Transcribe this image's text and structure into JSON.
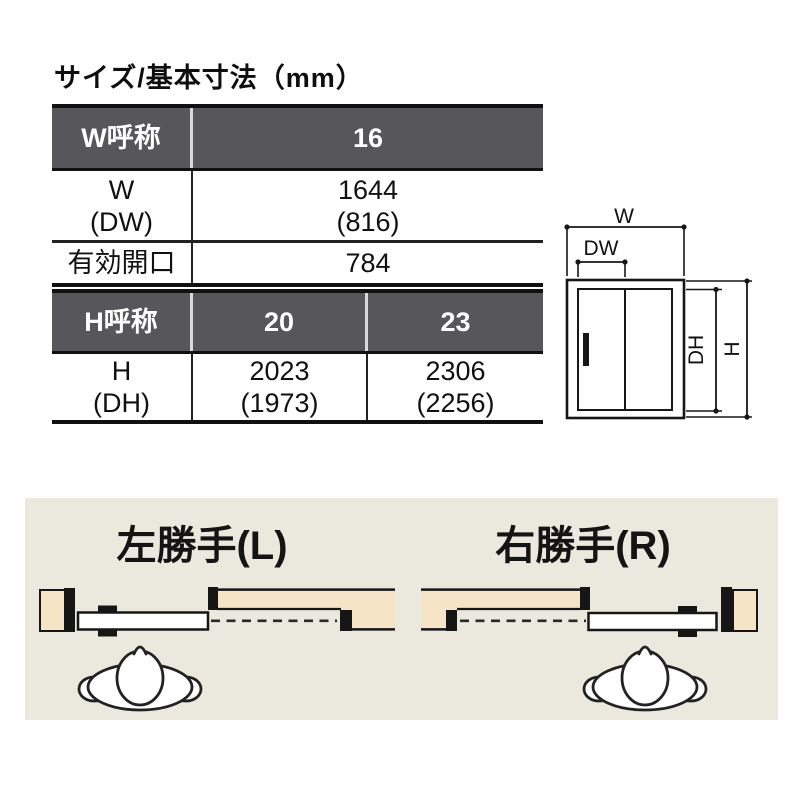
{
  "title": "サイズ/基本寸法（mm）",
  "table_w": {
    "header": {
      "label": "W呼称",
      "value": "16"
    },
    "rows": [
      {
        "label_line1": "W",
        "label_line2": "(DW)",
        "value_line1": "1644",
        "value_line2": "(816)"
      },
      {
        "label": "有効開口",
        "value": "784"
      }
    ]
  },
  "table_h": {
    "header": {
      "label": "H呼称",
      "col1": "20",
      "col2": "23"
    },
    "row": {
      "label_line1": "H",
      "label_line2": "(DH)",
      "col1_line1": "2023",
      "col1_line2": "(1973)",
      "col2_line1": "2306",
      "col2_line2": "(2256)"
    }
  },
  "door_diagram": {
    "labels": {
      "w": "W",
      "dw": "DW",
      "dh": "DH",
      "h": "H"
    }
  },
  "handing": {
    "left": {
      "title": "左勝手(L)"
    },
    "right": {
      "title": "右勝手(R)"
    }
  },
  "colors": {
    "header_bg": "#57565b",
    "wall_fill": "#f5e5c6",
    "panel_bg": "#ebe9dd",
    "line": "#161616"
  }
}
